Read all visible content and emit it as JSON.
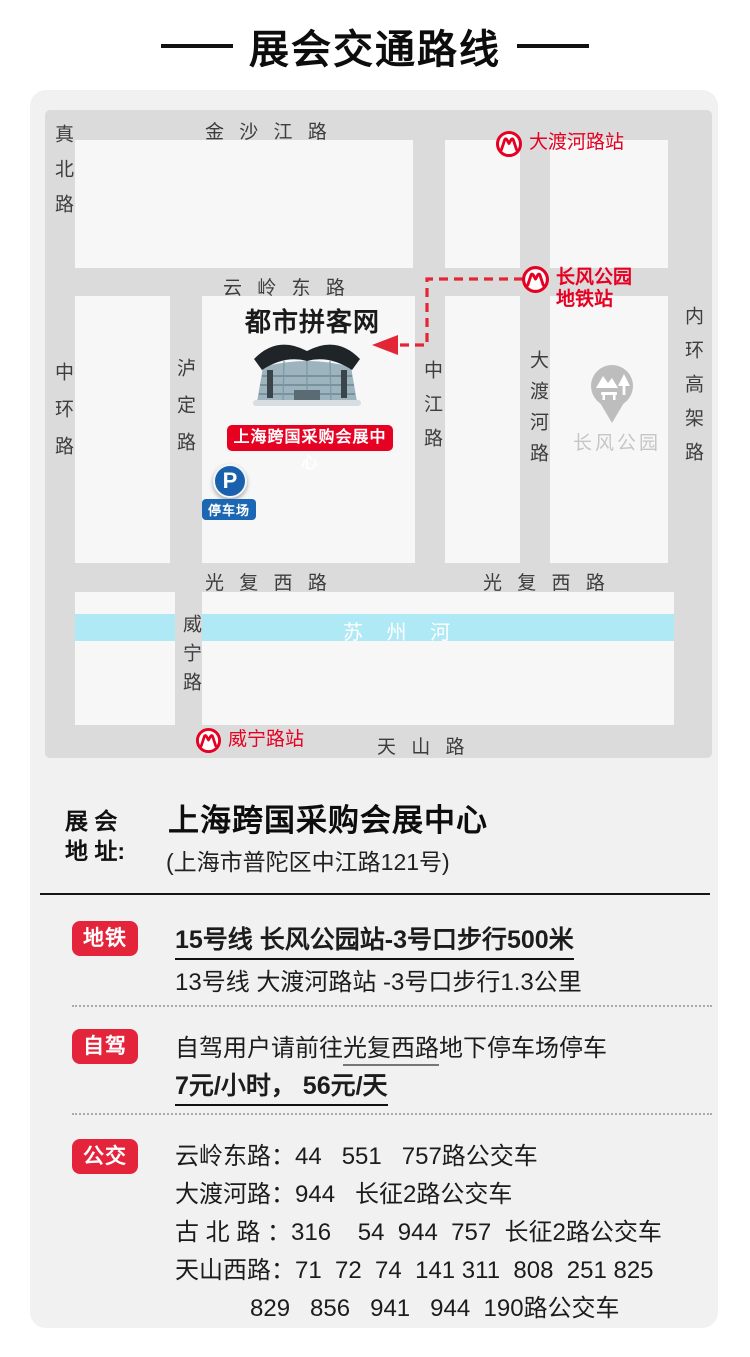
{
  "title": "展会交通路线",
  "map": {
    "roads": {
      "jinshajiang": "金 沙 江 路",
      "zhenbei": "真北路",
      "yunling": "云 岭 东 路",
      "zhonghuan": "中环路",
      "luding": "泸定路",
      "zhongjiang": "中江路",
      "daduhe": "大渡河路",
      "neihuan": "内环高架路",
      "guangfu_west": "光 复 西 路",
      "guangfu_east": "光 复 西 路",
      "weining": "威宁路",
      "tianshan": "天 山 路"
    },
    "river": "苏 州 河",
    "stations": {
      "daduhe": "大渡河路站",
      "changfeng_line1": "长风公园",
      "changfeng_line2": "地铁站",
      "weining": "威宁路站"
    },
    "venue": {
      "watermark": "都市拼客网",
      "label": "上海跨国采购会展中心"
    },
    "parking": {
      "symbol": "P",
      "label": "停车场"
    },
    "park": "长风公园"
  },
  "address": {
    "label": "展 会\n地 址:",
    "name": "上海跨国采购会展中心",
    "detail": "(上海市普陀区中江路121号)"
  },
  "metro": {
    "badge": "地铁",
    "line1": "15号线 长风公园站-3号口步行500米",
    "line2": "13号线 大渡河路站 -3号口步行1.3公里"
  },
  "drive": {
    "badge": "自驾",
    "line1_pre": "自驾用户请前往",
    "line1_underline": "光复西路",
    "line1_post": "地下停车场停车",
    "line2": "7元/小时， 56元/天"
  },
  "bus": {
    "badge": "公交",
    "lines": [
      "云岭东路：44   551   757路公交车",
      "大渡河路：944   长征2路公交车",
      "古 北 路 ：316    54  944  757  长征2路公交车",
      "天山西路：71  72  74  141 311  808  251 825",
      "829   856   941   944  190路公交车"
    ]
  },
  "colors": {
    "accent_red": "#e4243b",
    "station_red": "#e60021",
    "parking_blue": "#1961ad",
    "river_cyan": "#b0e9f6",
    "road_gray": "#dbdbdb"
  }
}
